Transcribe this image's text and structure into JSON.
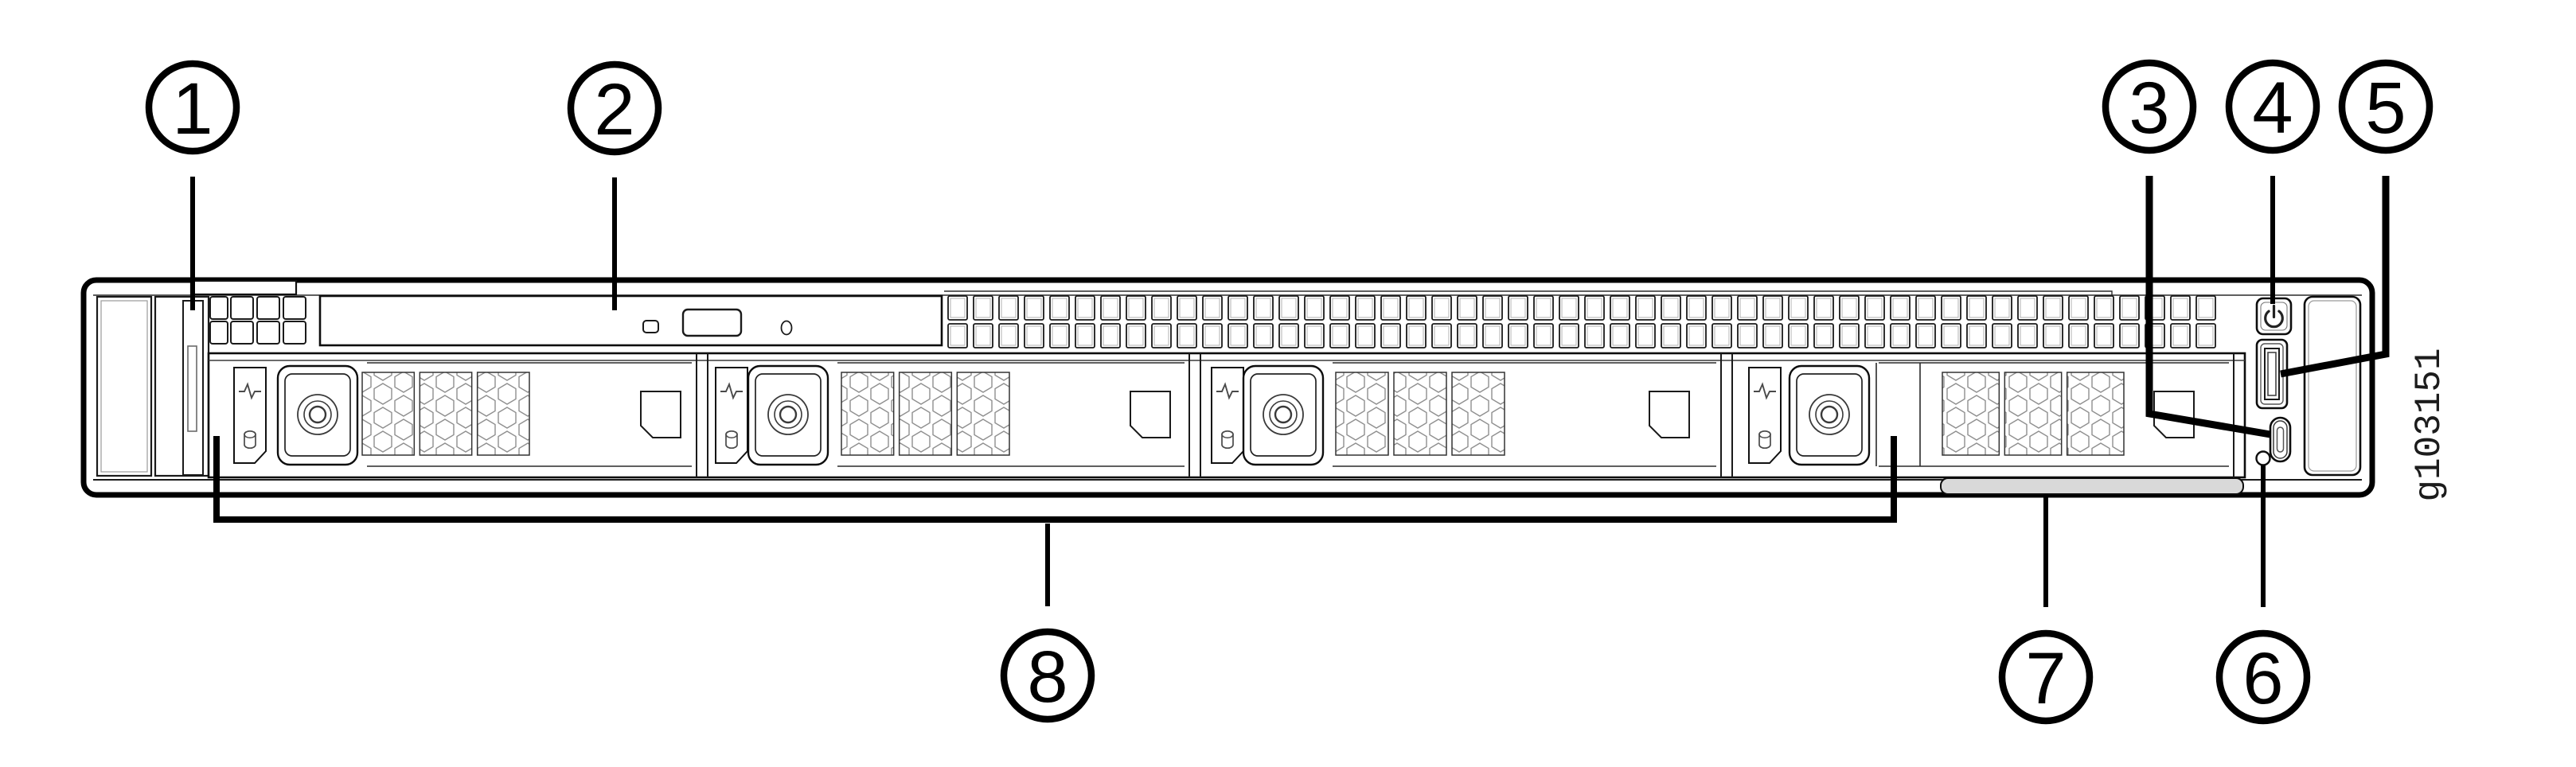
{
  "figure": {
    "graphic_id": "g103151",
    "description": "Front panel diagram of a 1U rack server chassis with numbered callouts",
    "background_color": "#ffffff",
    "line_color": "#000000",
    "detail_line_color": "#4a4a4a",
    "honeycomb_line_color": "#8f8f8f",
    "asset_tag_fill": "#d9d9d9"
  },
  "callouts": [
    {
      "label": "1",
      "target": "left-control-panel-strip",
      "row": "top"
    },
    {
      "label": "2",
      "target": "optical-drive",
      "row": "top"
    },
    {
      "label": "3",
      "target": "usb-c-port",
      "row": "top"
    },
    {
      "label": "4",
      "target": "power-button",
      "row": "top"
    },
    {
      "label": "5",
      "target": "usb-a-port",
      "row": "top"
    },
    {
      "label": "6",
      "target": "indicator-led",
      "row": "bottom"
    },
    {
      "label": "7",
      "target": "pull-out-asset-tag",
      "row": "bottom"
    },
    {
      "label": "8",
      "target": "drive-bays",
      "row": "bottom"
    }
  ],
  "drive_bay_count": 4,
  "drive_bay_icons": [
    "drive-activity-heartbeat-icon",
    "disk-cylinder-icon"
  ],
  "right_panel_items": [
    "power-button",
    "usb-a-port",
    "usb-c-port",
    "indicator-led"
  ]
}
